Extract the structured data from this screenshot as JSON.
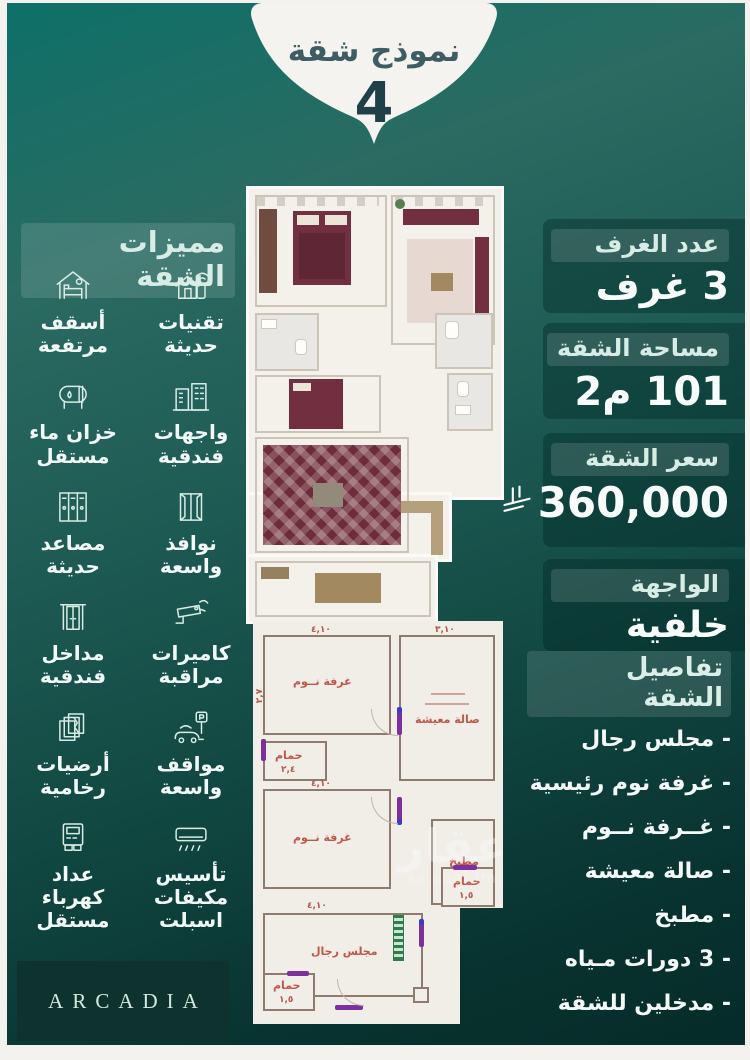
{
  "badge": {
    "title": "نموذج شقة",
    "number": "4"
  },
  "features": {
    "title": "مميزات الشقة",
    "items": [
      {
        "icon": "smart-home-icon",
        "label": "تقنيات\nحديثة"
      },
      {
        "icon": "high-ceiling-icon",
        "label": "أسقف\nمرتفعة"
      },
      {
        "icon": "hotel-building-icon",
        "label": "واجهات\nفندقية"
      },
      {
        "icon": "water-tank-icon",
        "label": "خزان ماء\nمستقل"
      },
      {
        "icon": "window-icon",
        "label": "نوافذ\nواسعة"
      },
      {
        "icon": "elevator-icon",
        "label": "مصاعد\nحديثة"
      },
      {
        "icon": "cctv-icon",
        "label": "كاميرات\nمراقبة"
      },
      {
        "icon": "entrance-icon",
        "label": "مداخل\nفندقية"
      },
      {
        "icon": "parking-icon",
        "label": "مواقف\nواسعة"
      },
      {
        "icon": "marble-icon",
        "label": "أرضيات\nرخامية"
      },
      {
        "icon": "ac-icon",
        "label": "تأسيس\nمكيفات\nاسبلت"
      },
      {
        "icon": "meter-icon",
        "label": "عداد\nكهرباء\nمستقل"
      }
    ]
  },
  "stats": {
    "rooms": {
      "label": "عدد الغرف",
      "value": "3 غرف"
    },
    "area": {
      "label": "مساحة الشقة",
      "value": "101 م2"
    },
    "price": {
      "label": "سعر الشقة",
      "value": "360,000",
      "currency_icon": "saudi-riyal-symbol"
    },
    "facade": {
      "label": "الواجهة",
      "value": "خلفية"
    }
  },
  "details": {
    "title": "تفاصيل الشقة",
    "items": [
      "- مجلس رجال",
      "- غرفة نوم رئيسية",
      "- غــرفة نــوم",
      "- صالة معيشة",
      "- مطبخ",
      "- 3 دورات مـياه",
      "- مدخلين للشقة"
    ]
  },
  "plan2d": {
    "bedroom_top": "غرفة نــوم",
    "living": "صالة معيشة",
    "bath_mid": "حمام",
    "bedroom_bottom": "غرفة نــوم",
    "kitchen": "مطبخ",
    "majlis": "مجلس رجال",
    "bath_right": "حمام",
    "bath_bottom": "حمام",
    "dims": {
      "d1": "٤,١٠",
      "d2": "٣,١٠",
      "d3": "٢,٧",
      "d4": "٢,٤",
      "d5": "٤,١٠",
      "d6": "٤,١٠",
      "d7": "١,٥",
      "d8": "١,٥"
    }
  },
  "watermark": {
    "name": "عقار",
    "site": "sa.aqar.fm"
  },
  "brand": "ARCADIA",
  "colors": {
    "teal_light": "#0d7069",
    "teal_dark": "#062b28",
    "maroon": "#722f3f",
    "mint": "#d7ece5"
  }
}
